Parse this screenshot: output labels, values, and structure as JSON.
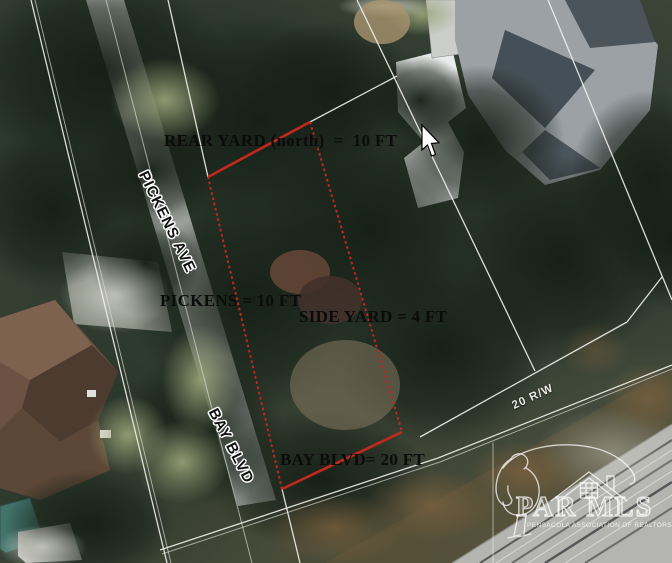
{
  "map": {
    "labels": {
      "rear_yard": "REAR YARD (north)  =  10 FT",
      "pickens": "PICKENS = 10 FT",
      "side_yard": "SIDE YARD = 4 FT",
      "bay_blvd": "BAY BLVD= 20 FT"
    },
    "streets": {
      "pickens_ave": "PICKENS AVE",
      "bay_blvd": "BAY BLVD"
    },
    "right_of_way": "20 R/W",
    "watermark": {
      "brand": "PAR MLS",
      "subtext": "PENSACOLA ASSOCIATION OF REALTORS"
    },
    "colors": {
      "parcel_outline": "#c1281e",
      "boundary_line": "#f0f0ec"
    },
    "parcel": {
      "edges": [
        {
          "side": "north",
          "points": "208,177 310,122"
        },
        {
          "side": "east",
          "points": "310,122 402,432"
        },
        {
          "side": "south",
          "points": "402,432 282,489"
        },
        {
          "side": "west",
          "points": "282,489 208,177"
        }
      ]
    }
  }
}
